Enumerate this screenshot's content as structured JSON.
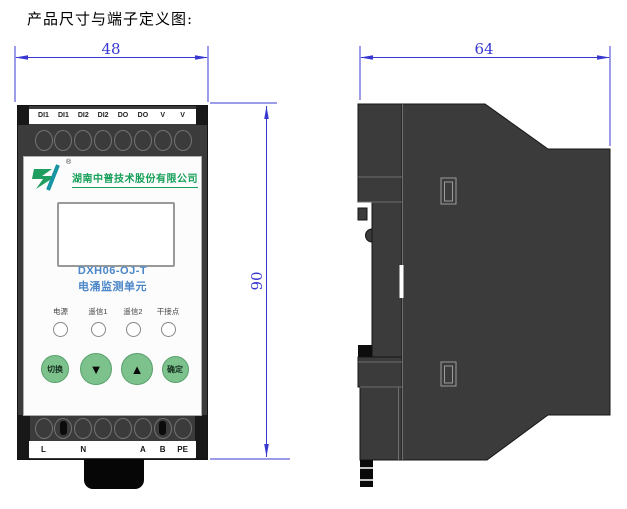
{
  "title": "产品尺寸与端子定义图:",
  "dimensions": {
    "front_width": "48",
    "front_height": "90",
    "side_depth": "64"
  },
  "front_view": {
    "top_terminals": [
      "DI1",
      "DI1",
      "DI2",
      "DI2",
      "DO",
      "DO",
      "V",
      "V"
    ],
    "brand": {
      "company": "湖南中普技术股份有限公司",
      "registered_mark": "®"
    },
    "display": {
      "model": "DXH06-OJ-T",
      "product_name": "电涌监测单元"
    },
    "leds": [
      {
        "label": "电源"
      },
      {
        "label": "遥信1"
      },
      {
        "label": "遥信2"
      },
      {
        "label": "干接点"
      }
    ],
    "buttons": [
      {
        "label": "切换"
      },
      {
        "label": "▼"
      },
      {
        "label": "▲"
      },
      {
        "label": "确定"
      }
    ],
    "bottom_terminals": [
      "L",
      "N",
      "A",
      "B",
      "PE"
    ]
  },
  "colors": {
    "dimension": "#3838d0",
    "brand_green": "#17a05a",
    "model_blue": "#4a86c8",
    "button_green": "#7dc28d",
    "body_gray": "#3b3b3b"
  }
}
